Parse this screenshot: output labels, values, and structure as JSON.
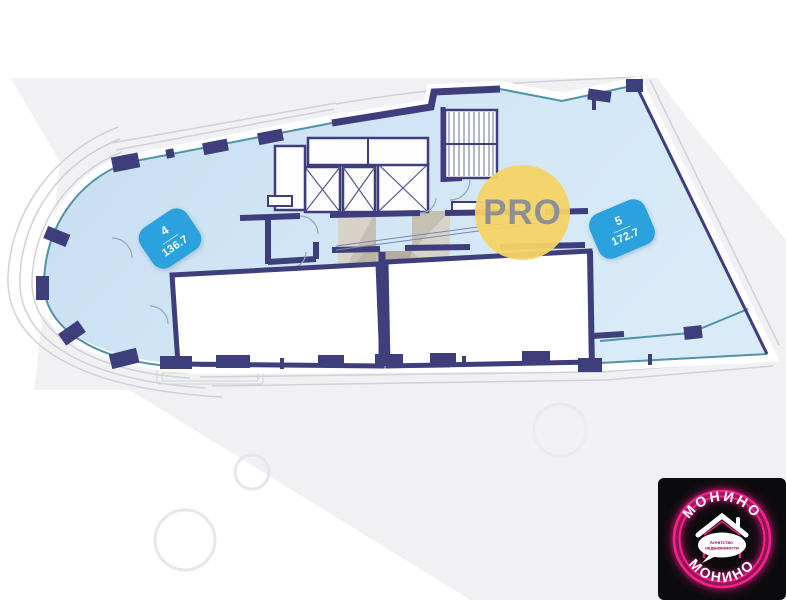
{
  "plan": {
    "type": "floor-plan",
    "units": [
      {
        "number": "4",
        "area": "136.7"
      },
      {
        "number": "5",
        "area": "172.7"
      }
    ],
    "features": [
      "elevator-shafts",
      "staircase",
      "curved-balcony",
      "glazed-facade"
    ]
  },
  "logos": {
    "pro": {
      "text": "PRO",
      "circle_color": "#f5d264",
      "text_color": "#8f9094"
    },
    "monino": {
      "arc_top": "МОНИНО",
      "arc_bottom": "МОНИНО",
      "bubble_line1": "Агентство",
      "bubble_line2": "недвижимости",
      "bg_color": "#0b0b0d",
      "neon_color": "#ff1f8f"
    }
  },
  "colors": {
    "plan_fill": "#cfe4f5",
    "walls": "#3e3e7c",
    "glass_line": "#4f93a5",
    "unit_badge": "#2ba2de",
    "watermark_beige": "#c6beae",
    "background": "#f1f1f4"
  }
}
